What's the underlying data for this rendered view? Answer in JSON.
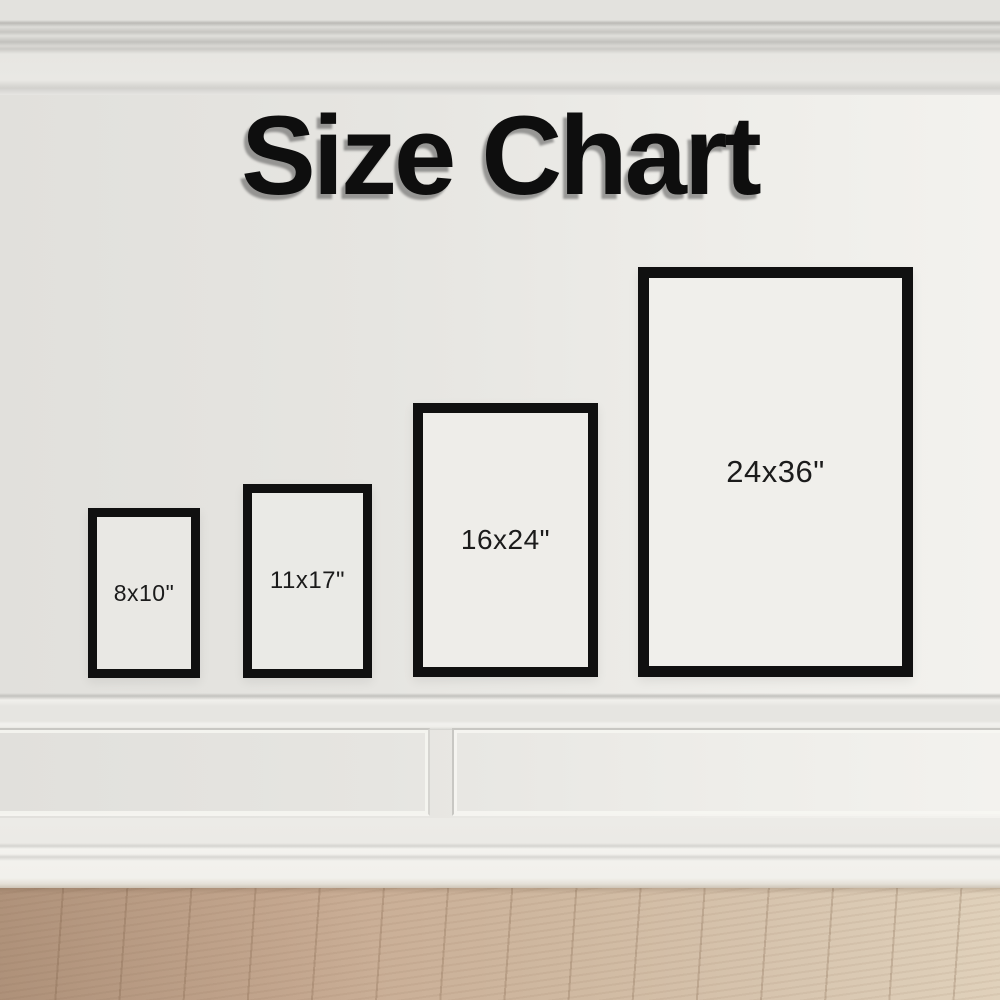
{
  "title": "Size Chart",
  "frames": [
    {
      "label": "8x10\""
    },
    {
      "label": "11x17\""
    },
    {
      "label": "16x24\""
    },
    {
      "label": "24x36\""
    }
  ],
  "colors": {
    "frame_border": "#101010",
    "wall": "#e6e5e1",
    "floor_left": "#bfa189",
    "floor_right": "#e0d1bb",
    "title_text": "#0e0e0e"
  },
  "chart_data": {
    "type": "table",
    "title": "Size Chart",
    "categories": [
      "8x10\"",
      "11x17\"",
      "16x24\"",
      "24x36\""
    ],
    "series": [
      {
        "name": "width_inches",
        "values": [
          8,
          11,
          16,
          24
        ]
      },
      {
        "name": "height_inches",
        "values": [
          10,
          17,
          24,
          36
        ]
      }
    ],
    "layout": "frames displayed left-to-right in ascending size, bottom-aligned on a wall"
  }
}
